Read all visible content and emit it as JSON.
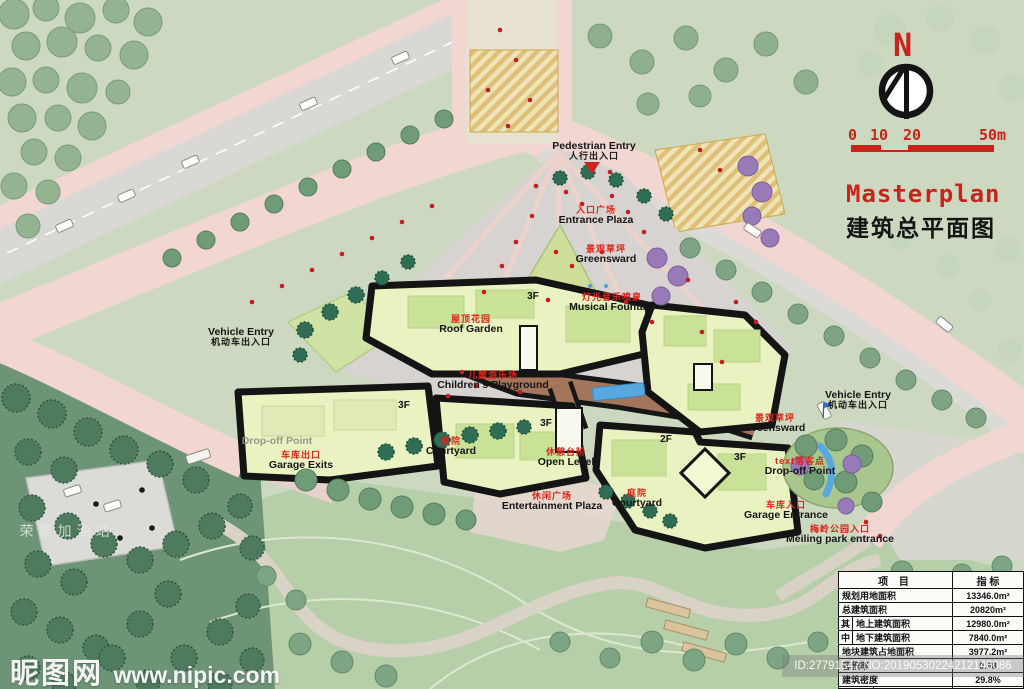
{
  "title": {
    "en": "Masterplan",
    "zh": "建筑总平面图"
  },
  "compass": {
    "north": "N"
  },
  "scale_bar": {
    "ticks": [
      "0",
      "10",
      "20",
      "50m"
    ]
  },
  "map_labels": {
    "pedestrian_entry": {
      "en": "Pedestrian Entry",
      "zh": "人行出入口"
    },
    "entrance_plaza": {
      "zh": "入口广场",
      "en": "Entrance Plaza"
    },
    "greensward_top": {
      "zh": "景观草坪",
      "en": "Greensward"
    },
    "musical_fountain": {
      "zh": "灯光音乐喷泉",
      "en": "Musical Fountain"
    },
    "roof_garden": {
      "zh": "屋顶花园",
      "en": "Roof Garden"
    },
    "vehicle_entry_left": {
      "en": "Vehicle Entry",
      "zh": "机动车出入口"
    },
    "childrens_playground": {
      "zh": "儿童游乐场",
      "en": "Children's Playground"
    },
    "vehicle_entry_right": {
      "en": "Vehicle Entry",
      "zh": "机动车出入口"
    },
    "greensward_right": {
      "zh": "景观草坪",
      "en": "Greensward"
    },
    "garage_exits": {
      "zh": "车库出口",
      "en": "Garage Exits"
    },
    "drop_off_left": {
      "en": "Drop-off Point"
    },
    "courtyard_left": {
      "zh": "庭院",
      "en": "Courtyard"
    },
    "open_level": {
      "zh": "休憩台阶",
      "en": "Open Level"
    },
    "entertainment_plaza": {
      "zh": "休闲广场",
      "en": "Entertainment Plaza"
    },
    "courtyard_right": {
      "zh": "庭院",
      "en": "Courtyard"
    },
    "drop_off_right": {
      "zh": "text落客点",
      "en": "Drop-off Point"
    },
    "garage_entrance": {
      "zh": "车库入口",
      "en": "Garage Entrance"
    },
    "meiling_park_entrance": {
      "zh": "梅岭公园入口",
      "en": "Meiling park entrance"
    },
    "gas_station": {
      "zh": "荣泰加油站"
    }
  },
  "floor_labels": [
    "3F",
    "3F",
    "3F",
    "2F",
    "3F"
  ],
  "indicator_table": {
    "header": {
      "item": "项 目",
      "value": "指 标"
    },
    "rows": [
      {
        "label": "规划用地面积",
        "value": "13346.0m²"
      },
      {
        "label": "总建筑面积",
        "value": "20820m²"
      },
      {
        "group": "其",
        "label": "地上建筑面积",
        "value": "12980.0m²"
      },
      {
        "group": "中",
        "label": "地下建筑面积",
        "value": "7840.0m²"
      },
      {
        "label": "地块建筑占地面积",
        "value": "3977.2m²"
      },
      {
        "label": "容积率",
        "value": "0.98"
      },
      {
        "label": "建筑密度",
        "value": "29.8%"
      },
      {
        "group": "停车位",
        "label": "地面停车位",
        "value": "38个"
      }
    ]
  },
  "watermarks": {
    "site_name": "昵图网",
    "site_url": "www.nipic.com",
    "id_text": "ID:27791547 NO:20190530224212146086"
  },
  "colors": {
    "title_red": "#c9231c",
    "label_red": "#e02318",
    "road_pink": "#f1d6d2",
    "plaza_gray": "#d6d3d1",
    "building_roof": "#e9f2c0",
    "building_outline": "#141414",
    "corridor_brown": "#a3765b",
    "water_blue": "#58a8e0",
    "crosswalk_tan": "#dfc078",
    "park_green": "#b7cfa9",
    "forest_green": "#4e7a5e"
  }
}
